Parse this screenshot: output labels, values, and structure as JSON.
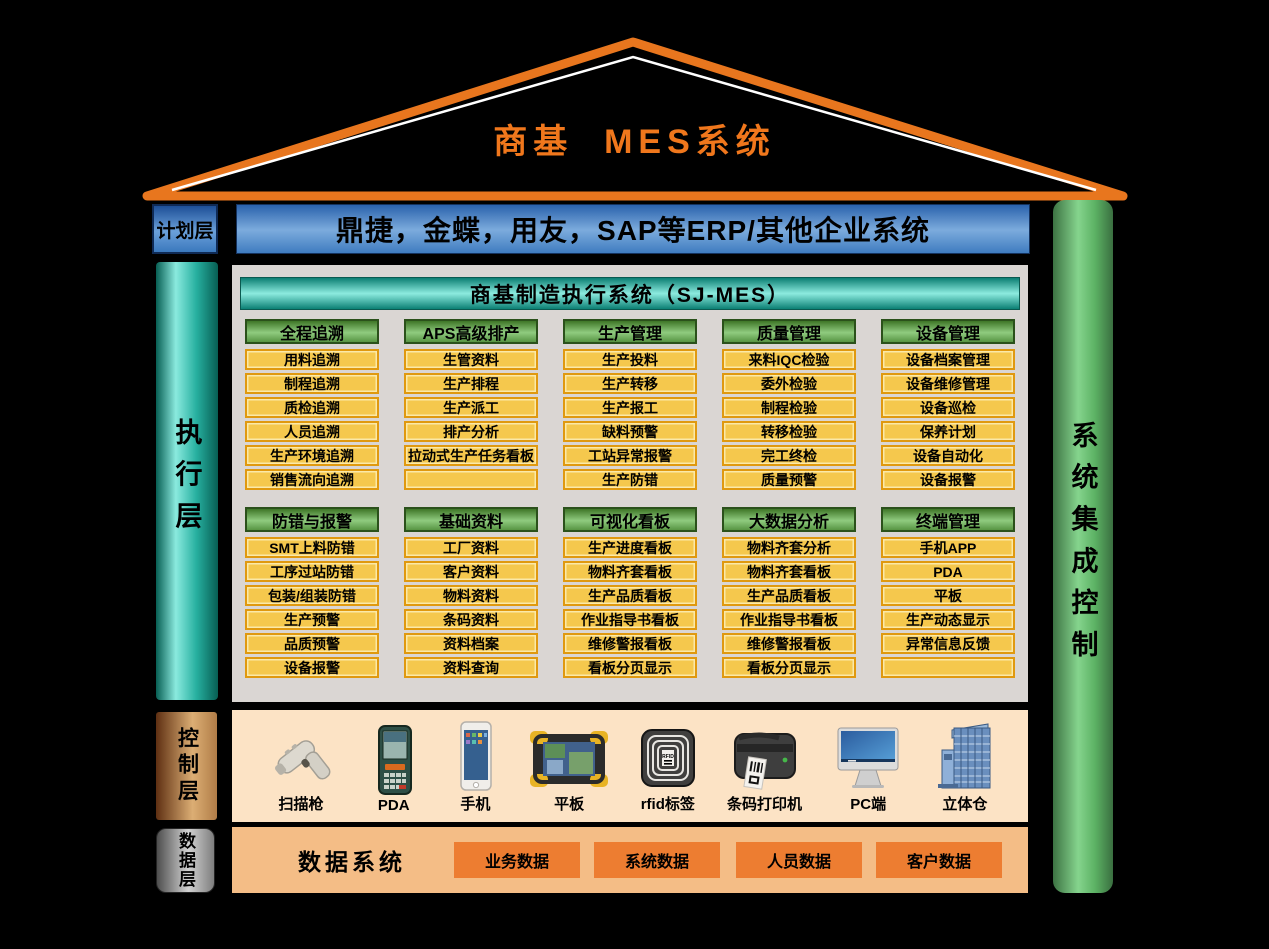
{
  "title": "商基  MES系统",
  "layers": {
    "plan": {
      "label": "计划层",
      "erp_bar": "鼎捷，金蝶，用友，SAP等ERP/其他企业系统"
    },
    "execute": {
      "label": "执行层"
    },
    "control": {
      "label": "控制层"
    },
    "data": {
      "label": "数据层"
    }
  },
  "right_bar": {
    "label": "系统集成控制"
  },
  "mes_panel": {
    "header": "商基制造执行系统（SJ-MES）",
    "rows": [
      [
        {
          "header": "全程追溯",
          "items": [
            "用料追溯",
            "制程追溯",
            "质检追溯",
            "人员追溯",
            "生产环境追溯",
            "销售流向追溯"
          ]
        },
        {
          "header": "APS高级排产",
          "items": [
            "生管资料",
            "生产排程",
            "生产派工",
            "排产分析",
            "拉动式生产任务看板",
            ""
          ]
        },
        {
          "header": "生产管理",
          "items": [
            "生产投料",
            "生产转移",
            "生产报工",
            "缺料预警",
            "工站异常报警",
            "生产防错"
          ]
        },
        {
          "header": "质量管理",
          "items": [
            "来料IQC检验",
            "委外检验",
            "制程检验",
            "转移检验",
            "完工终检",
            "质量预警"
          ]
        },
        {
          "header": "设备管理",
          "items": [
            "设备档案管理",
            "设备维修管理",
            "设备巡检",
            "保养计划",
            "设备自动化",
            "设备报警"
          ]
        }
      ],
      [
        {
          "header": "防错与报警",
          "items": [
            "SMT上料防错",
            "工序过站防错",
            "包装/组装防错",
            "生产预警",
            "品质预警",
            "设备报警"
          ]
        },
        {
          "header": "基础资料",
          "items": [
            "工厂资料",
            "客户资料",
            "物料资料",
            "条码资料",
            "资料档案",
            "资料查询"
          ]
        },
        {
          "header": "可视化看板",
          "items": [
            "生产进度看板",
            "物料齐套看板",
            "生产品质看板",
            "作业指导书看板",
            "维修警报看板",
            "看板分页显示"
          ]
        },
        {
          "header": "大数据分析",
          "items": [
            "物料齐套分析",
            "物料齐套看板",
            "生产品质看板",
            "作业指导书看板",
            "维修警报看板",
            "看板分页显示"
          ]
        },
        {
          "header": "终端管理",
          "items": [
            "手机APP",
            "PDA",
            "平板",
            "生产动态显示",
            "异常信息反馈",
            ""
          ]
        }
      ]
    ]
  },
  "devices": [
    {
      "label": "扫描枪",
      "icon": "barcode-scanner-icon"
    },
    {
      "label": "PDA",
      "icon": "pda-icon"
    },
    {
      "label": "手机",
      "icon": "smartphone-icon"
    },
    {
      "label": "平板",
      "icon": "tablet-icon"
    },
    {
      "label": "rfid标签",
      "icon": "rfid-tag-icon"
    },
    {
      "label": "条码打印机",
      "icon": "label-printer-icon"
    },
    {
      "label": "PC端",
      "icon": "pc-monitor-icon"
    },
    {
      "label": "立体仓",
      "icon": "warehouse-icon"
    }
  ],
  "data_layer": {
    "system_label": "数据系统",
    "boxes": [
      "业务数据",
      "系统数据",
      "人员数据",
      "客户数据"
    ]
  },
  "colors": {
    "roof_orange": "#e8761e",
    "title_orange": "#f0771c",
    "erp_blue": "#4a86c6",
    "exec_teal": "#17a393",
    "integration_green": "#6fc379",
    "module_header_green": "#6aae58",
    "item_yellow": "#f5c84d",
    "item_border_orange": "#e0990f",
    "control_peach": "#fce3c5",
    "data_peach": "#f4bd86",
    "data_box_orange": "#ed7d31"
  }
}
